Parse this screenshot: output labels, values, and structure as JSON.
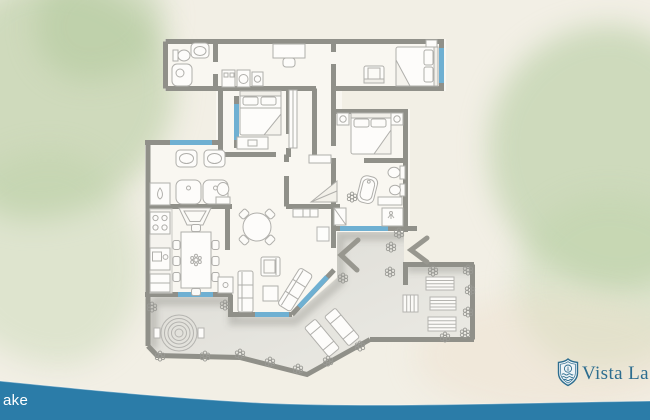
{
  "canvas": {
    "width": 650,
    "height": 420,
    "background_color": "#f2efe5"
  },
  "branding": {
    "logo_text": "Vista La",
    "logo_icon": "shield-sun-waves-icon",
    "logo_color": "#2d6d8f",
    "watermark_text": "ake",
    "watermark_color": "#ffffff",
    "wave_color": "#2b7ca8"
  },
  "palette": {
    "wall": "#909089",
    "floor": "#f9f7f1",
    "terrace_floor": "#e2e1dc",
    "furniture_line": "#b0afab",
    "window_glass": "#6fb0d2",
    "watercolor_wash": "#aec89a"
  },
  "floor_plan": {
    "type": "apartment-floor-plan-top-view",
    "window_count": 7,
    "door_chevron_count": 2,
    "plant_count": 20,
    "rooms": [
      "guest-bathroom",
      "laundry",
      "study-nook",
      "bedroom-right-wing",
      "bedroom-a",
      "bedroom-b",
      "master-bathroom",
      "ensuite-bathroom",
      "dressing-area",
      "hallway",
      "entry",
      "kitchen",
      "dining-area",
      "living-room",
      "terrace",
      "patio-deck"
    ],
    "furniture": [
      "toilet",
      "wall-sink",
      "shower-stall",
      "washer-dryer-units",
      "desk-with-chair",
      "loveseat",
      "double-bed-right-wing",
      "double-bed-a",
      "dresser",
      "double-bed-b",
      "nightstands-with-lamps",
      "bathtub",
      "bidet",
      "double-vanity-sinks",
      "water-heater",
      "double-shower",
      "stove",
      "kitchen-sink",
      "fridge",
      "dining-table-8-chairs",
      "fireplace",
      "round-table-4-chairs",
      "armchair",
      "coffee-table",
      "sofa",
      "chaise-sofa",
      "console-table",
      "stairs-ramp",
      "wardrobe",
      "entry-bench",
      "spiral-ground-feature",
      "sun-loungers",
      "deck-mats"
    ]
  }
}
